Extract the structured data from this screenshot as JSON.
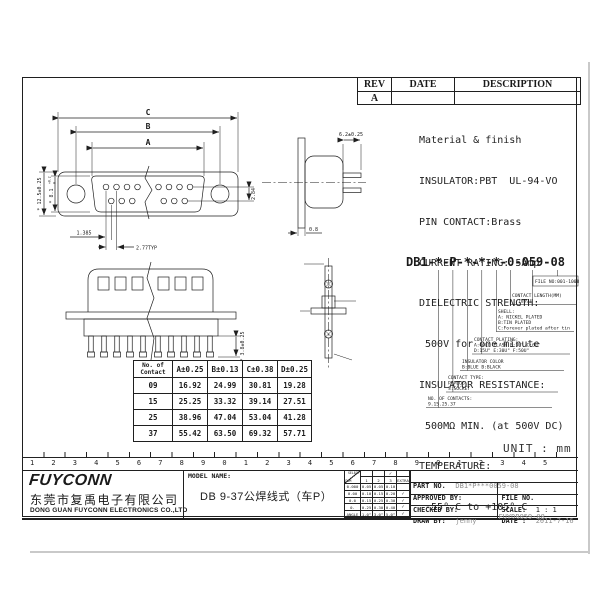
{
  "rev_table": {
    "headers": [
      "REV",
      "DATE",
      "DESCRIPTION"
    ],
    "row_rev": "A"
  },
  "material": {
    "lines": [
      "Material & finish",
      "INSULATOR:PBT  UL-94-VO",
      "PIN CONTACT:Brass",
      "CURRENT RATING: 5Amp",
      "DIELECTRIC STRENGTH:",
      " 500V for one minute",
      "INSULATOR RESISTANCE:",
      " 500MΩ MIN. (at 500V DC)",
      "TEMPERATURE:",
      " -55° C to +105° C"
    ]
  },
  "front_view": {
    "dim_c": "C",
    "dim_b": "B",
    "dim_a": "A",
    "left_outer": "* 12.5±0.25",
    "left_inner": "* 8.1",
    "tol_top": "+0.2",
    "tol_bot": "0",
    "right": "2.84",
    "half_pitch": "1.385",
    "pitch": "2.77TYP"
  },
  "side_view": {
    "top": "6.2±0.25",
    "bottom": "0.8"
  },
  "rear_view": {
    "right": "* 3.8±0.25"
  },
  "part_code": {
    "title": "DB1-*-P-*-*-*-0-059-08",
    "file_no": "FILE NO:001-1008",
    "length": [
      "CONTACT LENGTH(MM)",
      "(059)"
    ],
    "shell": [
      "SHELL:",
      "A: NICKEL PLATED",
      "B:TIN PLATED",
      "C:Forever plated after tin"
    ],
    "plating": [
      "CONTACT PLATING:",
      "A:GOLD FLASH  B:3U\" C:6U\"",
      "D:15U\" E:30U\" F:50U\""
    ],
    "color": [
      "INSULATOR COLOR",
      "B:BLUE  B:BLACK"
    ],
    "type": [
      "CONTACT TYPE:",
      "P:PLUG",
      "S:SOCKET"
    ],
    "contacts": [
      "NO. OF CONTACTS:",
      "9.15.25.37"
    ]
  },
  "contact_table": {
    "corner": [
      "No. of",
      "Contact"
    ],
    "headers": [
      "A±0.25",
      "B±0.13",
      "C±0.38",
      "D±0.25"
    ],
    "rows": [
      [
        "09",
        "16.92",
        "24.99",
        "30.81",
        "19.28"
      ],
      [
        "15",
        "25.25",
        "33.32",
        "39.14",
        "27.51"
      ],
      [
        "25",
        "38.96",
        "47.04",
        "53.04",
        "41.28"
      ],
      [
        "37",
        "55.42",
        "63.50",
        "69.32",
        "57.71"
      ]
    ]
  },
  "unit_label": "UNIT : mm",
  "ruler": {
    "digits": "1234567890123456789012345"
  },
  "title_block": {
    "logo": "FUYCONN",
    "company_cn": "东莞市复禹电子有限公司",
    "company_en": "DONG GUAN FUYCONN ELECTRONICS CO.,LTD",
    "model_label": "MODEL NAME:",
    "model_value": "DB 9-37公焊线式（车P）",
    "tolerance": {
      "select": "SELECT",
      "dim": "DIM",
      "check": "✓",
      "cols": [
        "1",
        "2",
        "3",
        "EXTRA"
      ],
      "rows": [
        [
          "0.000",
          "0.05",
          "0.05",
          "0.10",
          ""
        ],
        [
          "0.00",
          "0.10",
          "0.15",
          "0.20",
          "✓"
        ],
        [
          "0.0",
          "0.15",
          "0.25",
          "0.30",
          "✓"
        ],
        [
          "0.",
          "0.25",
          "0.30",
          "0.40",
          "✓"
        ],
        [
          "ANGLE",
          "1.0°",
          "3.0°",
          "5.0°",
          "✓"
        ]
      ]
    },
    "part_no_label": "PART NO.",
    "part_no_value": "DB1*P***0059-08",
    "approved_label": "APPROVED BY:",
    "checked_label": "CHECKED BY:",
    "draw_label": "DRAW BY:",
    "draw_value": "jenny",
    "file_no_label": "FILE NO.",
    "file_no_value": "FUYDB059-08",
    "scale_label": "SCALE:",
    "scale_value": "1 : 1",
    "date_label": "DATE :",
    "date_value": "2011-7-16"
  }
}
